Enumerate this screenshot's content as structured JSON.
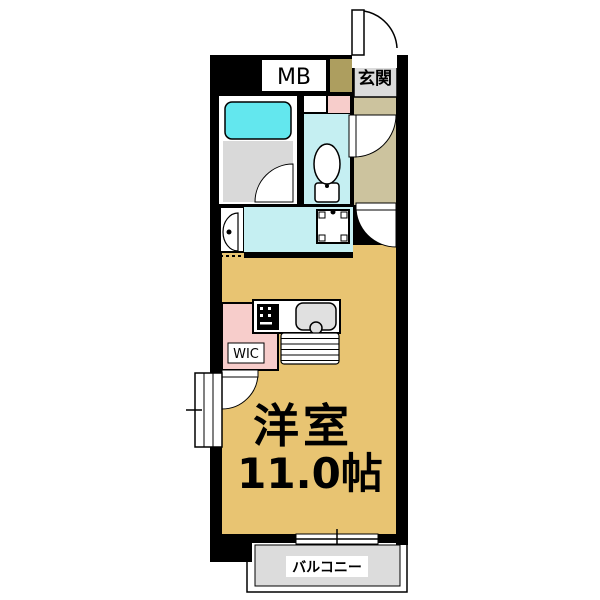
{
  "floorplan": {
    "type": "japanese-apartment-floor-plan",
    "labels": {
      "meter_box": "MB",
      "entrance": "玄関",
      "walk_in_closet": "WIC",
      "main_room_name": "洋室",
      "main_room_size": "11.0帖",
      "balcony": "バルコニー"
    },
    "colors": {
      "wall": "#000000",
      "main_room_floor": "#E8C472",
      "hallway_floor": "#CCC39E",
      "meter_box_shaft": "#AD9E5F",
      "bathtub": "#63E7EE",
      "wet_area": "#C5EFF2",
      "closet_pink": "#F7CDCB",
      "bath_floor_gray": "#D9D9D9",
      "balcony_gray": "#DCDCDC",
      "label_gray": "#DBDBDB",
      "sink_gray": "#E0E0E0",
      "fixture_white": "#FFFFFF"
    }
  }
}
